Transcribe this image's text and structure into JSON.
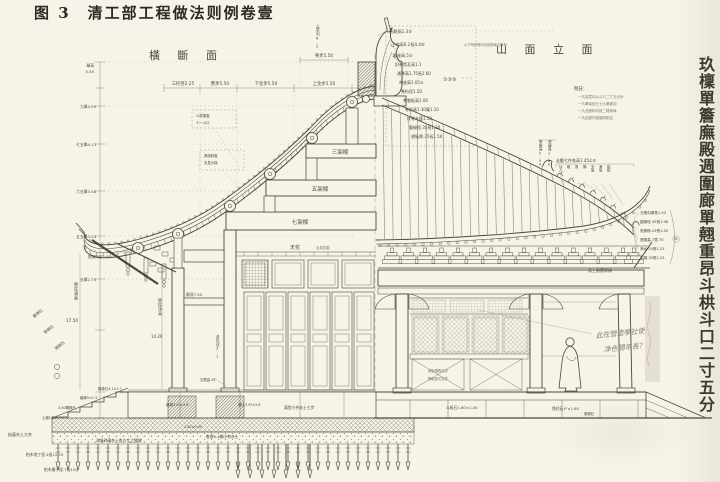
{
  "title": "图 3　清工部工程做法则例卷壹",
  "section_titles": {
    "cross_section": "橫 斷 面",
    "side_elevation": "山 面 立 面"
  },
  "right_margin_caption": "玖檁單簷廡殿週圍廊單翹重昂斗栱斗口二寸五分",
  "colors": {
    "paper": "#f7f3e8",
    "ink": "#4c463a",
    "light_ink": "#948c7c",
    "pencil": "#8a8173"
  },
  "annotations": [
    {
      "name": "ann-shaba",
      "text": "剎靶高1.3③",
      "x": 389,
      "y": 33,
      "fs": 4.2
    },
    {
      "name": "ann-zhengwen",
      "text": "正吻高6.2長4.4⑤",
      "x": 391,
      "y": 46,
      "fs": 4.2
    },
    {
      "name": "ann-zhengwen-note",
      "text": "以下吻獸脊料均按琉璃瓦料例",
      "x": 464,
      "y": 46,
      "fs": 3.3,
      "color": "#7d766a"
    },
    {
      "name": "ann-shouzuo",
      "text": "獸座高.5③",
      "x": 393,
      "y": 57,
      "fs": 4
    },
    {
      "name": "ann-kouji",
      "text": "扣脊筒瓦高1.1",
      "x": 395,
      "y": 66,
      "fs": 4
    },
    {
      "name": "ann-tongji",
      "text": "通脊高1.75長2.60",
      "x": 397,
      "y": 75,
      "fs": 4
    },
    {
      "name": "ann-wenzuo",
      "text": "吻座高1.05③",
      "x": 399,
      "y": 84,
      "fs": 4
    },
    {
      "name": "ann-jiheng",
      "text": "脊桁徑1.50",
      "x": 401,
      "y": 93,
      "fs": 4
    },
    {
      "name": "ann-jidianban",
      "text": "脊墊板高1.00",
      "x": 403,
      "y": 102,
      "fs": 4
    },
    {
      "name": "ann-jifang",
      "text": "脊枋高1.30寬1.10",
      "x": 405,
      "y": 111,
      "fs": 4
    },
    {
      "name": "ann-fujimu",
      "text": "扶脊木徑1.50",
      "x": 407,
      "y": 120,
      "fs": 4
    },
    {
      "name": "ann-naochuan",
      "text": "腦椽徑.35長1.30",
      "x": 409,
      "y": 129,
      "fs": 4
    },
    {
      "name": "ann-wangban",
      "text": "望板厚.35長1.50",
      "x": 411,
      "y": 138,
      "fs": 4
    },
    {
      "name": "ann-ref-circles",
      "text": "①③③",
      "x": 443,
      "y": 81,
      "fs": 5
    },
    {
      "name": "ann-funote-title",
      "text": "附註：",
      "x": 574,
      "y": 90,
      "fs": 4.4
    },
    {
      "name": "ann-funote-1",
      "text": "一凡高寬均以斗口二寸五分計",
      "x": 578,
      "y": 98,
      "fs": 3.5,
      "color": "#7d766a"
    },
    {
      "name": "ann-funote-2",
      "text": "一凡舉架依五七九舉遞加",
      "x": 578,
      "y": 105,
      "fs": 3.5,
      "color": "#7d766a"
    },
    {
      "name": "ann-funote-3",
      "text": "一凡瓦獸料均按二樣琉璃",
      "x": 578,
      "y": 112,
      "fs": 3.5,
      "color": "#7d766a"
    },
    {
      "name": "ann-funote-4",
      "text": "一凡走獸件數臨時酌定",
      "x": 578,
      "y": 119,
      "fs": 3.5,
      "color": "#7d766a"
    },
    {
      "name": "ann-chuishou",
      "text": "垂獸高2.50",
      "x": 539,
      "y": 143,
      "fs": 3.5,
      "vert": true
    },
    {
      "name": "ann-lianzhuan",
      "text": "連磚長1.80",
      "x": 548,
      "y": 143,
      "fs": 3.5,
      "vert": true
    },
    {
      "name": "ann-zoushou",
      "text": "走獸七件各高1.45①②",
      "x": 556,
      "y": 162,
      "fs": 4
    },
    {
      "name": "ann-beast-1",
      "text": "仙人",
      "x": 559,
      "y": 168,
      "fs": 3.4,
      "vert": true
    },
    {
      "name": "ann-beast-2",
      "text": "龍",
      "x": 567,
      "y": 168,
      "fs": 3.4,
      "vert": true
    },
    {
      "name": "ann-beast-3",
      "text": "鳳",
      "x": 575,
      "y": 168,
      "fs": 3.4,
      "vert": true
    },
    {
      "name": "ann-beast-4",
      "text": "獅",
      "x": 583,
      "y": 168,
      "fs": 3.4,
      "vert": true
    },
    {
      "name": "ann-beast-5",
      "text": "天馬",
      "x": 591,
      "y": 168,
      "fs": 3.4,
      "vert": true
    },
    {
      "name": "ann-beast-6",
      "text": "海馬",
      "x": 599,
      "y": 168,
      "fs": 3.4,
      "vert": true
    },
    {
      "name": "ann-beast-7",
      "text": "狻猊",
      "x": 607,
      "y": 168,
      "fs": 3.4,
      "vert": true
    },
    {
      "name": "ann-corner-1",
      "text": "方眼勾頭長1.50",
      "x": 640,
      "y": 214,
      "fs": 3.6
    },
    {
      "name": "ann-corner-2",
      "text": "圓椽徑.45長1.98",
      "x": 640,
      "y": 223,
      "fs": 3.6
    },
    {
      "name": "ann-corner-3",
      "text": "飛簷椽.25長1.40",
      "x": 640,
      "y": 232,
      "fs": 3.6
    },
    {
      "name": "ann-corner-4",
      "text": "連簷高.7寬.70",
      "x": 640,
      "y": 241,
      "fs": 3.6
    },
    {
      "name": "ann-corner-5",
      "text": "滴水.25長1.25",
      "x": 640,
      "y": 250,
      "fs": 3.6
    },
    {
      "name": "ann-corner-6",
      "text": "勾頭.35長1.25",
      "x": 640,
      "y": 259,
      "fs": 3.6
    },
    {
      "name": "ann-corner-ref",
      "text": "①",
      "x": 676,
      "y": 240,
      "fs": 4,
      "anchor": "middle"
    },
    {
      "name": "ann-corner-caption",
      "text": "角上飛簷詳樣",
      "x": 588,
      "y": 272,
      "fs": 4
    },
    {
      "name": "ann-box1-l1",
      "text": "斗栱攢當",
      "x": 196,
      "y": 117,
      "fs": 3.4
    },
    {
      "name": "ann-box1-l2",
      "text": "十一斗口",
      "x": 196,
      "y": 124,
      "fs": 3.4
    },
    {
      "name": "ann-box2-l1",
      "text": "昂翹斜度",
      "x": 204,
      "y": 157,
      "fs": 3.4
    },
    {
      "name": "ann-box2-l2",
      "text": "另見大樣",
      "x": 204,
      "y": 164,
      "fs": 3.4
    },
    {
      "name": "ann-tiaoyanheng",
      "text": "挑簷桁徑3.00",
      "x": 88,
      "y": 258,
      "fs": 3.6
    },
    {
      "name": "ann-beam-3",
      "text": "三架樑",
      "x": 340,
      "y": 154,
      "fs": 5.5,
      "anchor": "middle"
    },
    {
      "name": "ann-beam-5",
      "text": "五架樑",
      "x": 320,
      "y": 191,
      "fs": 5.5,
      "anchor": "middle"
    },
    {
      "name": "ann-beam-7",
      "text": "七架樑",
      "x": 300,
      "y": 224,
      "fs": 5.5,
      "anchor": "middle"
    },
    {
      "name": "ann-tianhua",
      "text": "天花",
      "x": 290,
      "y": 249,
      "fs": 5
    },
    {
      "name": "ann-tianhua-note",
      "text": "另見詳圖",
      "x": 316,
      "y": 249,
      "fs": 3.4,
      "color": "#7d766a"
    },
    {
      "name": "ann-ladder-jugao",
      "text": "舉高",
      "x": 94,
      "y": 67,
      "fs": 3.8,
      "anchor": "end"
    },
    {
      "name": "ann-ladder-jugao-v",
      "text": "5.50",
      "x": 94,
      "y": 73,
      "fs": 3.8,
      "anchor": "end"
    },
    {
      "name": "ann-ladder-1",
      "text": "九舉4.95",
      "x": 96,
      "y": 108,
      "fs": 3.8,
      "anchor": "end"
    },
    {
      "name": "ann-ladder-2",
      "text": "七五舉4.13",
      "x": 96,
      "y": 146,
      "fs": 3.8,
      "anchor": "end"
    },
    {
      "name": "ann-ladder-3",
      "text": "六五舉3.58",
      "x": 96,
      "y": 193,
      "fs": 3.8,
      "anchor": "end"
    },
    {
      "name": "ann-ladder-4",
      "text": "五五舉3.03",
      "x": 96,
      "y": 238,
      "fs": 3.8,
      "anchor": "end"
    },
    {
      "name": "ann-ladder-5",
      "text": "五舉2.75",
      "x": 96,
      "y": 281,
      "fs": 3.8,
      "anchor": "end"
    },
    {
      "name": "ann-topdim-1",
      "text": "三桁徑2.25",
      "x": 183,
      "y": 85,
      "fs": 4.3,
      "anchor": "middle"
    },
    {
      "name": "ann-topdim-2",
      "text": "簷步5.50",
      "x": 220,
      "y": 85,
      "fs": 4.3,
      "anchor": "middle"
    },
    {
      "name": "ann-topdim-3",
      "text": "下金步5.50",
      "x": 266,
      "y": 85,
      "fs": 4.3,
      "anchor": "middle"
    },
    {
      "name": "ann-topdim-4",
      "text": "上金步5.50",
      "x": 324,
      "y": 85,
      "fs": 4.3,
      "anchor": "middle"
    },
    {
      "name": "ann-topdim-jibu",
      "text": "脊步5.50",
      "x": 324,
      "y": 57,
      "fs": 4.3,
      "anchor": "middle"
    },
    {
      "name": "ann-shangyanchu",
      "text": "上簷出6.2",
      "x": 316,
      "y": 27,
      "fs": 3.8,
      "vert": true
    },
    {
      "name": "ann-yanzhu-tonggao",
      "text": "簷柱通高",
      "x": 74,
      "y": 286,
      "fs": 4.2,
      "vert": true
    },
    {
      "name": "ann-yanzhu-tonggao-v",
      "text": "17.50",
      "x": 66,
      "y": 322,
      "fs": 4.2
    },
    {
      "name": "ann-yanzhu-jinggao",
      "text": "簷柱凈高",
      "x": 158,
      "y": 302,
      "fs": 4,
      "vert": true
    },
    {
      "name": "ann-yanzhu-jinggao-v",
      "text": "14.29",
      "x": 151,
      "y": 338,
      "fs": 4
    },
    {
      "name": "ann-langshen",
      "text": "廊深7.50",
      "x": 186,
      "y": 296,
      "fs": 3.8
    },
    {
      "name": "ann-jinzhu-jing",
      "text": "金柱徑3.1",
      "x": 216,
      "y": 338,
      "fs": 3.6,
      "vert": true
    },
    {
      "name": "ann-gujing",
      "text": "古鏡高.45",
      "x": 200,
      "y": 381,
      "fs": 3.4
    },
    {
      "name": "ann-chuidai",
      "text": "垂帶石",
      "x": 34,
      "y": 318,
      "fs": 3.8,
      "rot": -38
    },
    {
      "name": "ann-xiangyan",
      "text": "象眼石",
      "x": 45,
      "y": 334,
      "fs": 3.8,
      "rot": -38
    },
    {
      "name": "ann-taduo",
      "text": "踏跺石",
      "x": 56,
      "y": 350,
      "fs": 3.8,
      "rot": -38
    },
    {
      "name": "ann-jietiaoshi",
      "text": "階條石4.1×1.7",
      "x": 98,
      "y": 390,
      "fs": 3.4
    },
    {
      "name": "ann-taduo-dim",
      "text": "踏跺5×1.3",
      "x": 80,
      "y": 399,
      "fs": 3.4
    },
    {
      "name": "ann-jiangduo",
      "text": "3.50礓跺石",
      "x": 58,
      "y": 409,
      "fs": 3.4
    },
    {
      "name": "ann-tuchen",
      "text": "土襯1×.2",
      "x": 42,
      "y": 419,
      "fs": 3.4
    },
    {
      "name": "ann-sangdun",
      "text": "磉墩3.6²×3.6",
      "x": 166,
      "y": 406,
      "fs": 3.5
    },
    {
      "name": "ann-lantu",
      "text": "攔土3.6²×3.6",
      "x": 238,
      "y": 406,
      "fs": 3.5
    },
    {
      "name": "ann-mantang",
      "text": "滿堂小夯灰土七步",
      "x": 284,
      "y": 409,
      "fs": 3.8
    },
    {
      "name": "ann-dim-18090",
      "text": "1.80×0.90",
      "x": 184,
      "y": 428,
      "fs": 3.4
    },
    {
      "name": "ann-qiali",
      "text": "掐裏灰土大夯",
      "x": 8,
      "y": 436,
      "fs": 4
    },
    {
      "name": "ann-haiman",
      "text": "海墁碎磚灰土各方丈之鋪墁",
      "x": 96,
      "y": 442,
      "fs": 3.8
    },
    {
      "name": "ann-geceng",
      "text": "各層2.4細小夯灰土",
      "x": 206,
      "y": 438,
      "fs": 3.8
    },
    {
      "name": "ann-diding",
      "text": "柏木地丁徑.4長12-15",
      "x": 26,
      "y": 456,
      "fs": 3.8
    },
    {
      "name": "ann-zhuangzi",
      "text": "柏木樁子徑.7長12◎",
      "x": 44,
      "y": 471,
      "fs": 3.8
    },
    {
      "name": "ann-douban",
      "text": "斗板石1.80×1.40",
      "x": 446,
      "y": 409,
      "fs": 3.8
    },
    {
      "name": "ann-jiaozhu",
      "text": "角柱石4²×1.80",
      "x": 552,
      "y": 410,
      "fs": 3.8
    },
    {
      "name": "ann-xiangyanshi",
      "text": "象眼石",
      "x": 584,
      "y": 415,
      "fs": 3.4
    },
    {
      "name": "ann-qunban",
      "text": "裙板雕飾另詳",
      "x": 428,
      "y": 372,
      "fs": 3.3,
      "color": "#7d766a"
    },
    {
      "name": "ann-linghua",
      "text": "隔扇菱花另詳",
      "x": 428,
      "y": 380,
      "fs": 3.3,
      "color": "#7d766a"
    },
    {
      "name": "ann-handnote-1",
      "text": "此在營造學社使",
      "x": 596,
      "y": 338,
      "fs": 7,
      "rot": -6,
      "italic": true,
      "color": "#8a8173"
    },
    {
      "name": "ann-handnote-2",
      "text": "净色潤年長？",
      "x": 604,
      "y": 352,
      "fs": 7,
      "rot": -6,
      "italic": true,
      "color": "#8a8173"
    }
  ]
}
